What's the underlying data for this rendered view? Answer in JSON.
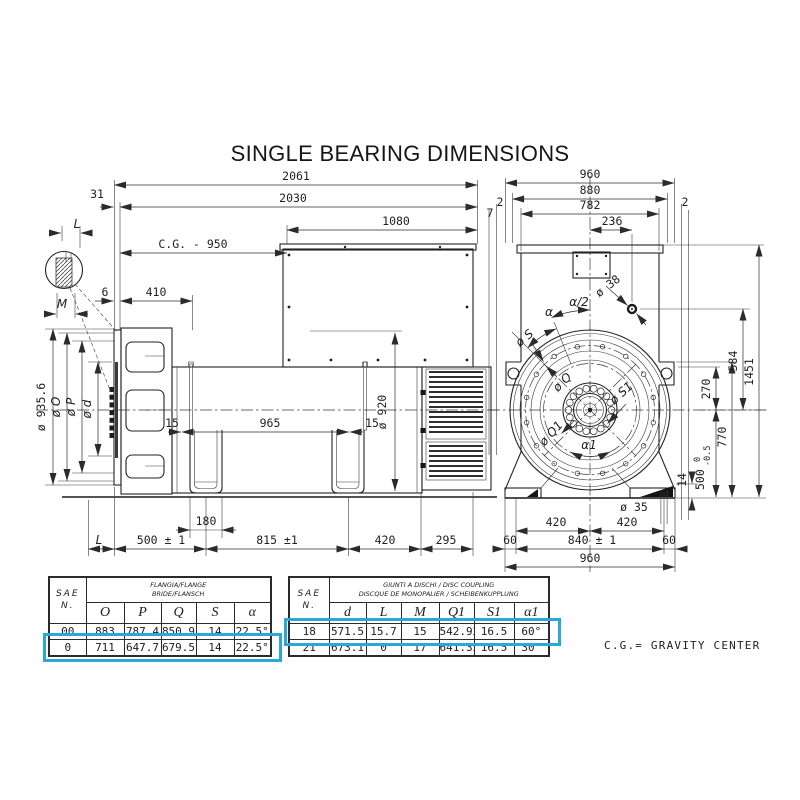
{
  "title": "SINGLE BEARING DIMENSIONS",
  "footnote": "C.G.= GRAVITY CENTER",
  "drawing": {
    "side": {
      "s_2061": "2061",
      "s_2030": "2030",
      "s_31": "31",
      "s_1080": "1080",
      "s_cg950": "C.G. - 950",
      "s_6": "6",
      "s_410": "410",
      "s_L_top": "L",
      "s_M": "M",
      "s_d935": "ø 935.6",
      "s_dO": "ø O",
      "s_dP": "ø P",
      "s_dd": "ø d",
      "s_15a": "15",
      "s_965": "965",
      "s_15b": "15",
      "s_d920": "ø 920",
      "s_180": "180",
      "s_L_bot": "L",
      "s_500": "500 ± 1",
      "s_815": "815 ±1",
      "s_420": "420",
      "s_295": "295"
    },
    "front": {
      "f_960_top": "960",
      "f_880": "880",
      "f_782": "782",
      "f_2a": "2",
      "f_7": "7",
      "f_2b": "2",
      "f_236": "236",
      "f_d38": "ø 38",
      "f_alpha": "α",
      "f_alpha_half": "α/2",
      "f_dS": "ø S",
      "f_dQ": "ø Q",
      "f_dS1": "ø S1",
      "f_dQ1": "ø Q1",
      "f_alpha1": "α1",
      "f_584": "584",
      "f_1451": "1451",
      "f_270": "270",
      "f_770": "770",
      "f_500": "500",
      "f_tol_hi": "0",
      "f_tol_lo": "-0.5",
      "f_14": "14",
      "f_d35": "ø 35",
      "f_420a": "420",
      "f_420b": "420",
      "f_840": "840 ± 1",
      "f_60a": "60",
      "f_60b": "60",
      "f_960_bot": "960"
    }
  },
  "flange_table": {
    "col_sae": "SAE",
    "col_n": "N.",
    "header_line1": "FLANGIA/FLANGE",
    "header_line2": "BRIDE/FLANSCH",
    "columns": [
      "O",
      "P",
      "Q",
      "S",
      "α"
    ],
    "rows": [
      {
        "sae": "00",
        "values": [
          "883",
          "787.4",
          "850.9",
          "14",
          "22.5°"
        ]
      },
      {
        "sae": "0",
        "values": [
          "711",
          "647.7",
          "679.5",
          "14",
          "22.5°"
        ]
      }
    ]
  },
  "coupling_table": {
    "col_sae": "SAE",
    "col_n": "N.",
    "header_line1": "GIUNTI A DISCHI / DISC COUPLING",
    "header_line2": "DISCQUE DE MONOPALIER / SCHEIBENKUPPLUNG",
    "columns": [
      "d",
      "L",
      "M",
      "Q1",
      "S1",
      "α1"
    ],
    "rows": [
      {
        "sae": "18",
        "values": [
          "571.5",
          "15.7",
          "15",
          "542.92",
          "16.5",
          "60°"
        ]
      },
      {
        "sae": "21",
        "values": [
          "673.1",
          "0",
          "17",
          "641.35",
          "16.5",
          "30°"
        ]
      }
    ]
  },
  "colors": {
    "highlight": "#2aa8d8",
    "line": "#2a2a2a",
    "background": "#ffffff"
  }
}
